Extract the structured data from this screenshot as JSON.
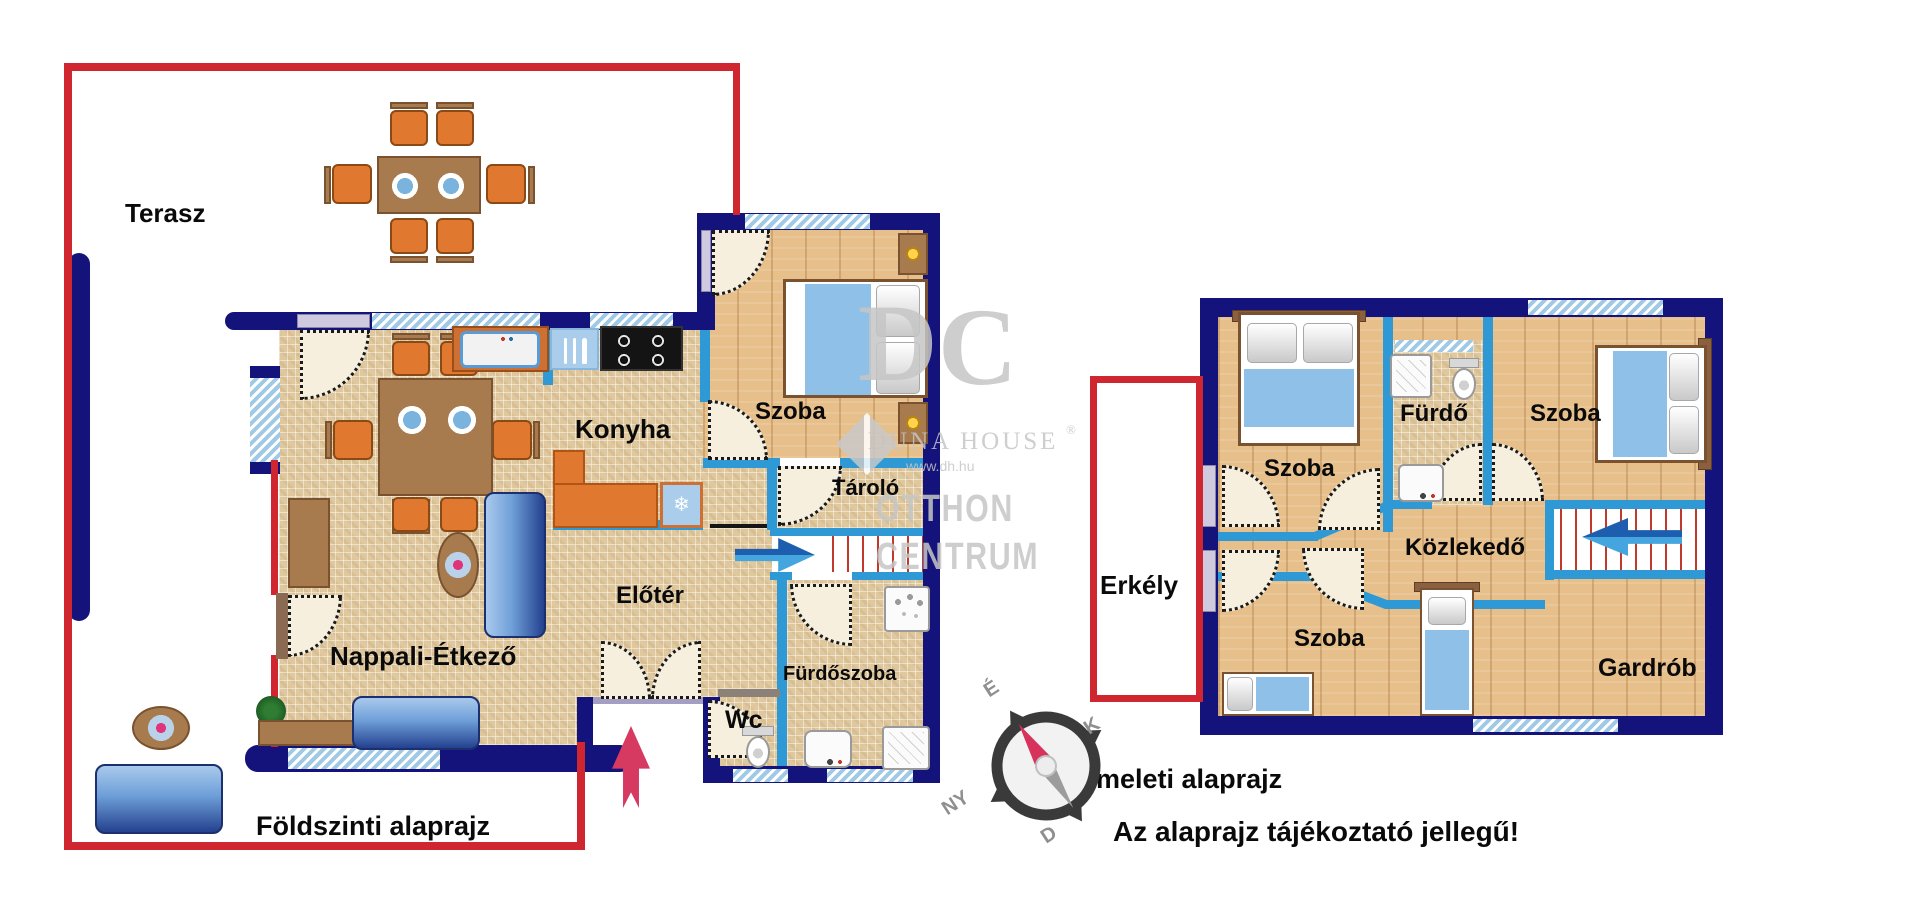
{
  "document": {
    "type": "floor-plan",
    "language": "hu"
  },
  "ground_floor": {
    "caption": "Földszinti alaprajz",
    "rooms": {
      "terasz": "Terasz",
      "konyha": "Konyha",
      "szoba": "Szoba",
      "tarolo": "Tároló",
      "eloter": "Előtér",
      "nappali_etkezo": "Nappali-Étkező",
      "furdoszoba": "Fürdőszoba",
      "wc": "Wc"
    }
  },
  "upper_floor": {
    "caption": "Emeleti alaprajz",
    "rooms": {
      "erkely": "Erkély",
      "szoba_felso_bal": "Szoba",
      "furdo": "Fürdő",
      "szoba_felso_jobb": "Szoba",
      "kozlekedo": "Közlekedő",
      "szoba_also": "Szoba",
      "gardrob": "Gardrób"
    }
  },
  "disclaimer": "Az alaprajz tájékoztató jellegű!",
  "compass": {
    "north": "É",
    "east": "K",
    "south": "D",
    "west": "NY"
  },
  "watermark": {
    "monogram_d": "D",
    "monogram_c": "C",
    "brand": "DUNA HOUSE",
    "registered": "®",
    "url": "www.dh.hu",
    "brand2_line1": "OTTHON",
    "brand2_line2": "CENTRUM"
  },
  "icons": {
    "fridge_snowflake": "❄"
  },
  "colors": {
    "outline_red": "#cf2630",
    "wall_navy": "#14137b",
    "partition_blue": "#2e99d4",
    "window_blue": "#9fc9e4",
    "arrow_blue_dark": "#1d5fae",
    "arrow_blue_light": "#45a5de",
    "arrow_entry_pink": "#d63a60",
    "tile_beige": "#dfc89e",
    "wood": "#e6bf8a",
    "furniture_orange": "#e0782f",
    "sofa_blue": "#6e9fd8"
  }
}
